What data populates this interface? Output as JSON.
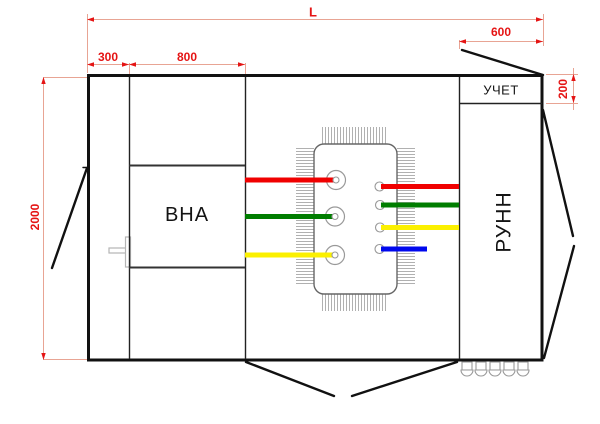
{
  "title": "KTP substation layout drawing (plan view)",
  "compartments": {
    "vna_label": "ВНА",
    "uchet_label": "УЧЕТ",
    "runn_label": "РУНН"
  },
  "dimensions": {
    "total_width": "L",
    "left_section_width": "300",
    "mid_section_width": "800",
    "right_section_width": "600",
    "uchet_height": "200",
    "total_depth": "2000"
  },
  "colors": {
    "dimension_text": "#e51414",
    "dimension_line": "#e8a494",
    "outline": "#111111",
    "busbar_phase_a_red": "#f00000",
    "busbar_phase_b_green": "#007d00",
    "busbar_phase_c_yellow": "#fbf000",
    "busbar_neutral_blue": "#0008ee",
    "transformer_outline": "#666666",
    "fins": "#b0b0b0"
  }
}
